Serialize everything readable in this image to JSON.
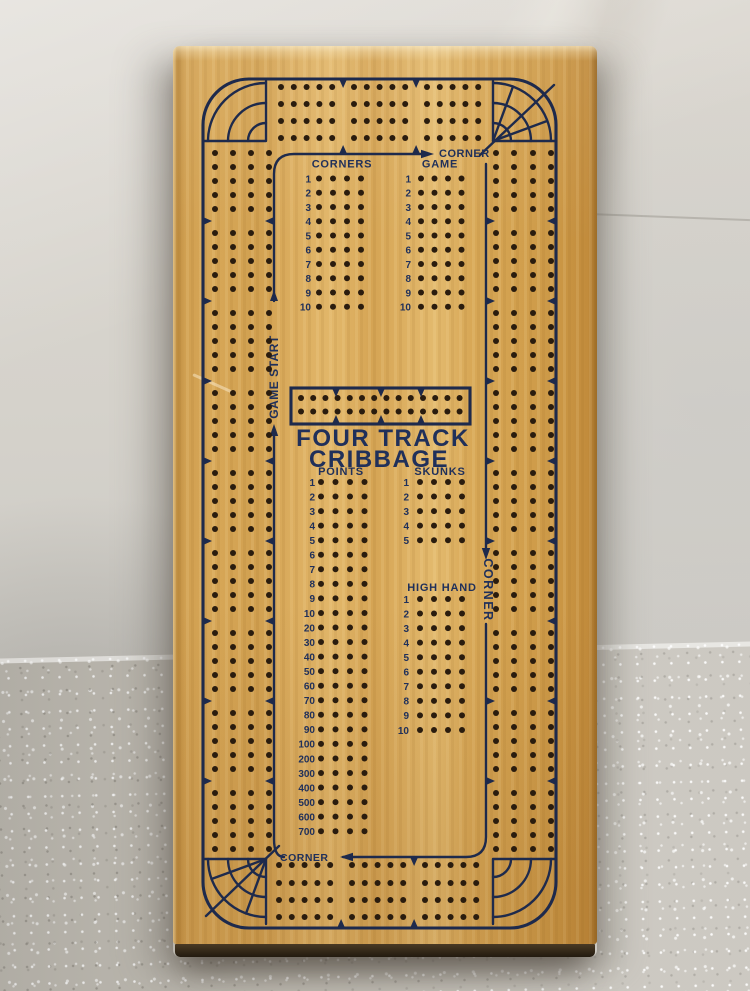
{
  "colors": {
    "ink": "#1e2a4c",
    "text": "#20305a",
    "hole": "#2a1c0e",
    "wood": "#d7a654",
    "wall": "#d5d2cb",
    "counter": "#c0bcb3"
  },
  "board": {
    "title_line1": "FOUR TRACK",
    "title_line2": "CRIBBAGE",
    "labels": {
      "corner_game_arrow": "CORNER",
      "game_start": "GAME START",
      "corner_right": "CORNER",
      "corner_bottom": "CORNER"
    },
    "blocks": [
      {
        "id": "corners",
        "header": "CORNERS",
        "header_x": 169,
        "header_y": 121.5,
        "num_x": 138,
        "rows_y0": 132.5,
        "rows_dy": 14.25,
        "holes_x": [
          146,
          160,
          174,
          188
        ],
        "numbers": [
          "1",
          "2",
          "3",
          "4",
          "5",
          "6",
          "7",
          "8",
          "9",
          "10"
        ]
      },
      {
        "id": "game",
        "header": "GAME",
        "header_x": 267,
        "header_y": 121.5,
        "num_x": 238,
        "rows_y0": 132.5,
        "rows_dy": 14.25,
        "holes_x": [
          248,
          261.5,
          275,
          288.5
        ],
        "numbers": [
          "1",
          "2",
          "3",
          "4",
          "5",
          "6",
          "7",
          "8",
          "9",
          "10"
        ]
      },
      {
        "id": "points",
        "header": "POINTS",
        "header_x": 168,
        "header_y": 429,
        "num_x": 142,
        "rows_y0": 436,
        "rows_dy": 14.55,
        "holes_x": [
          148,
          162.5,
          177,
          191.5
        ],
        "numbers": [
          "1",
          "2",
          "3",
          "4",
          "5",
          "6",
          "7",
          "8",
          "9",
          "10",
          "20",
          "30",
          "40",
          "50",
          "60",
          "70",
          "80",
          "90",
          "100",
          "200",
          "300",
          "400",
          "500",
          "600",
          "700"
        ]
      },
      {
        "id": "skunks",
        "header": "SKUNKS",
        "header_x": 267,
        "header_y": 429,
        "num_x": 236,
        "rows_y0": 436,
        "rows_dy": 14.55,
        "holes_x": [
          247,
          261,
          275,
          289
        ],
        "numbers": [
          "1",
          "2",
          "3",
          "4",
          "5"
        ]
      },
      {
        "id": "high-hand",
        "header": "HIGH HAND",
        "header_x": 269,
        "header_y": 545,
        "num_x": 236,
        "rows_y0": 553,
        "rows_dy": 14.55,
        "holes_x": [
          247,
          261,
          275,
          289
        ],
        "numbers": [
          "1",
          "2",
          "3",
          "4",
          "5",
          "6",
          "7",
          "8",
          "9",
          "10"
        ]
      }
    ],
    "geometry": {
      "strips": [
        {
          "id": "top-track",
          "dir": "h",
          "x0": 108,
          "count": 15,
          "per": 5,
          "gap": 12.8,
          "extra": 9,
          "lanes": [
            41,
            58,
            75,
            92
          ],
          "notch_lines": [
            {
              "pos": 33,
              "dir": "down",
              "ranges": [
                [
                  100,
                  310
                ]
              ]
            },
            {
              "pos": 108,
              "dir": "up",
              "ranges": [
                [
                  112,
                  246
                ]
              ]
            }
          ]
        },
        {
          "id": "bottom-track",
          "dir": "h",
          "x0": 106,
          "count": 15,
          "per": 5,
          "gap": 12.8,
          "extra": 9,
          "lanes": [
            819,
            837,
            854,
            871
          ],
          "notch_lines": [
            {
              "pos": 882,
              "dir": "up",
              "ranges": [
                [
                  100,
                  310
                ]
              ]
            },
            {
              "pos": 811,
              "dir": "down",
              "ranges": [
                [
                  176,
                  290
                ]
              ]
            }
          ]
        },
        {
          "id": "left-track",
          "dir": "v",
          "y0": 107,
          "count": 45,
          "per": 5,
          "gap": 14,
          "extra": 10,
          "lanes": [
            42,
            60,
            78,
            96
          ],
          "notch_lines": [
            {
              "pos": 30,
              "dir": "right",
              "ranges": [
                [
                  90,
                  830
                ]
              ]
            },
            {
              "pos": 101,
              "dir": "left",
              "ranges": [
                [
                  128,
                  248
                ],
                [
                  390,
                  790
                ]
              ]
            }
          ]
        },
        {
          "id": "right-track",
          "dir": "v",
          "y0": 107,
          "count": 45,
          "per": 5,
          "gap": 14,
          "extra": 10,
          "lanes": [
            323,
            341,
            360,
            378
          ],
          "notch_lines": [
            {
              "pos": 383,
              "dir": "left",
              "ranges": [
                [
                  90,
                  830
                ]
              ]
            },
            {
              "pos": 313,
              "dir": "right",
              "ranges": [
                [
                  120,
                  500
                ],
                [
                  580,
                  790
                ]
              ]
            }
          ]
        }
      ],
      "start_box": {
        "x": 118,
        "y": 342,
        "w": 179,
        "h": 36,
        "rows": [
          352,
          365.5
        ],
        "x0": 128,
        "count": 14,
        "gap": 12.2,
        "notches_x": [
          163,
          208,
          248
        ]
      }
    }
  }
}
